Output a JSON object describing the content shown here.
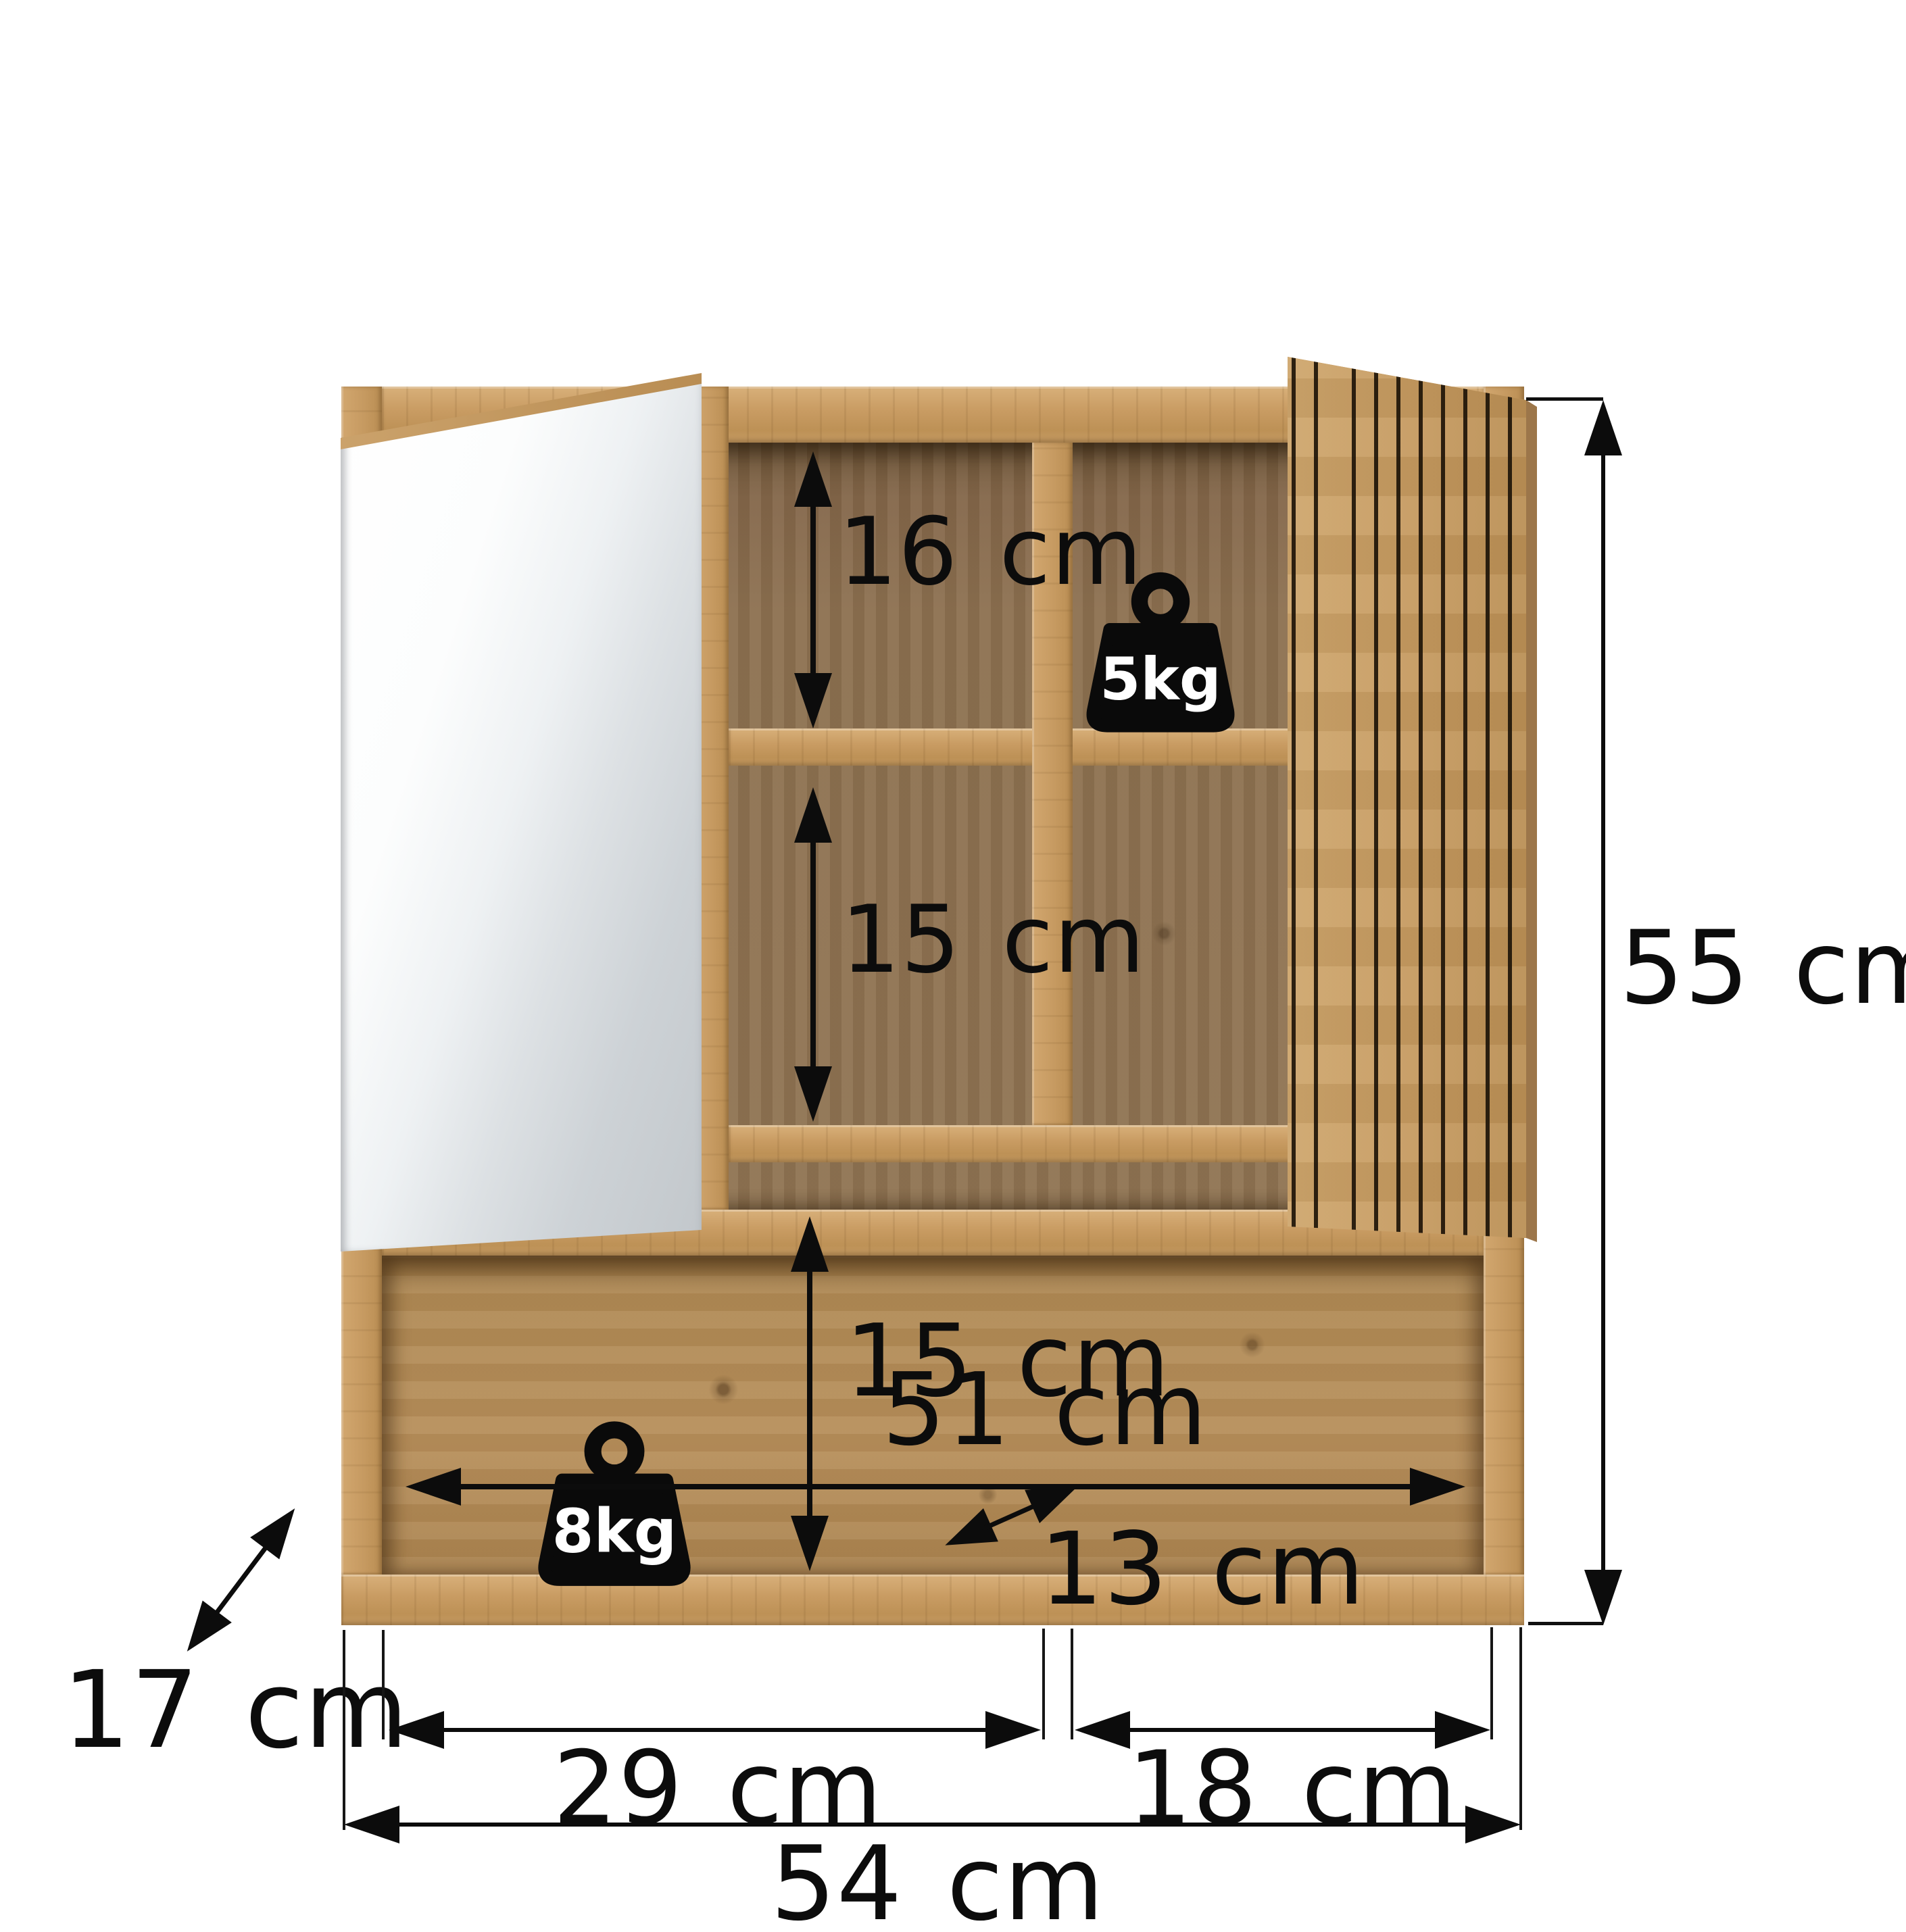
{
  "diagram": {
    "product": "Mirrored bathroom wall cabinet with slatted door",
    "view": "front dimension drawing",
    "units": "cm",
    "dimensions": {
      "total_width_label": "54 cm",
      "total_height_label": "55 cm",
      "depth_label": "17 cm",
      "top_compartment_height_label": "16 cm",
      "middle_compartment_height_label": "15 cm",
      "open_compartment_height_label": "15 cm",
      "open_compartment_width_label": "51 cm",
      "open_compartment_depth_label": "13 cm",
      "left_section_width_label": "29 cm",
      "right_section_width_label": "18 cm"
    },
    "load_capacity": {
      "interior_shelf": "5kg",
      "open_shelf": "8kg"
    },
    "colors": {
      "background": "#ffffff",
      "annotation": "#0c0c0c",
      "oak_front": "#c89c64",
      "oak_interior_dark": "#8a6d4e",
      "oak_interior_light": "#b18a57",
      "slat_groove": "#2e2213",
      "mirror_light": "#fdfefe",
      "mirror_dark": "#c3c8cc"
    }
  }
}
